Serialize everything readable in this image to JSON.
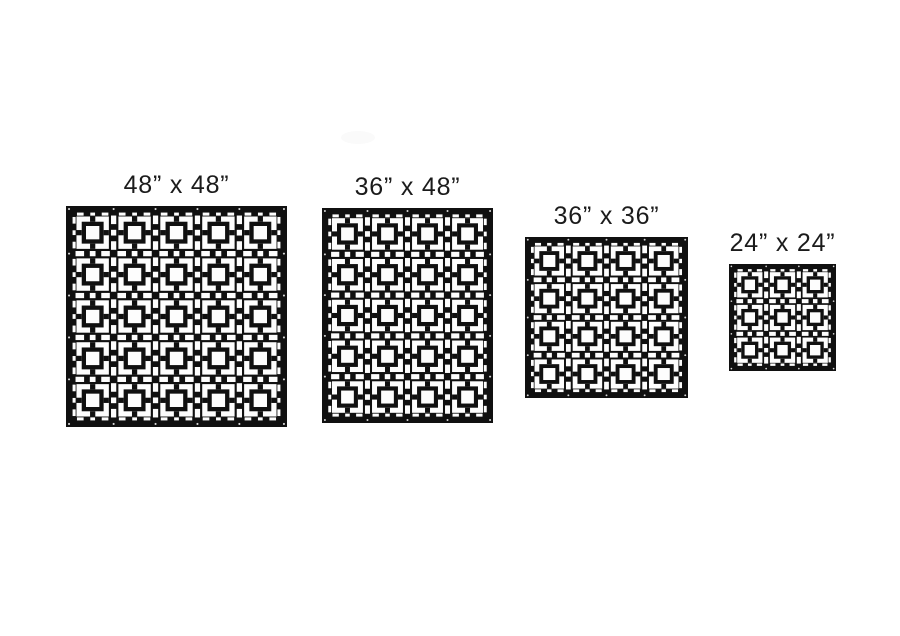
{
  "page": {
    "background_color": "#ffffff",
    "description_of_content": "Four black laser-cut decorative privacy screen panels shown in available sizes"
  },
  "pattern_style": {
    "panel_color": "#101010",
    "cutout_color": "#fdfdfd",
    "hole_color": "#d9d9d9",
    "motif": "square-in-square breeze-block grille with dashed gutters"
  },
  "panels": [
    {
      "label": "48” x 48”",
      "width_in": 48,
      "height_in": 48,
      "motif_cols": 5,
      "motif_rows": 5
    },
    {
      "label": "36” x 48”",
      "width_in": 36,
      "height_in": 48,
      "motif_cols": 4,
      "motif_rows": 5
    },
    {
      "label": "36” x 36”",
      "width_in": 36,
      "height_in": 36,
      "motif_cols": 4,
      "motif_rows": 4
    },
    {
      "label": "24” x 24”",
      "width_in": 24,
      "height_in": 24,
      "motif_cols": 3,
      "motif_rows": 3
    }
  ]
}
